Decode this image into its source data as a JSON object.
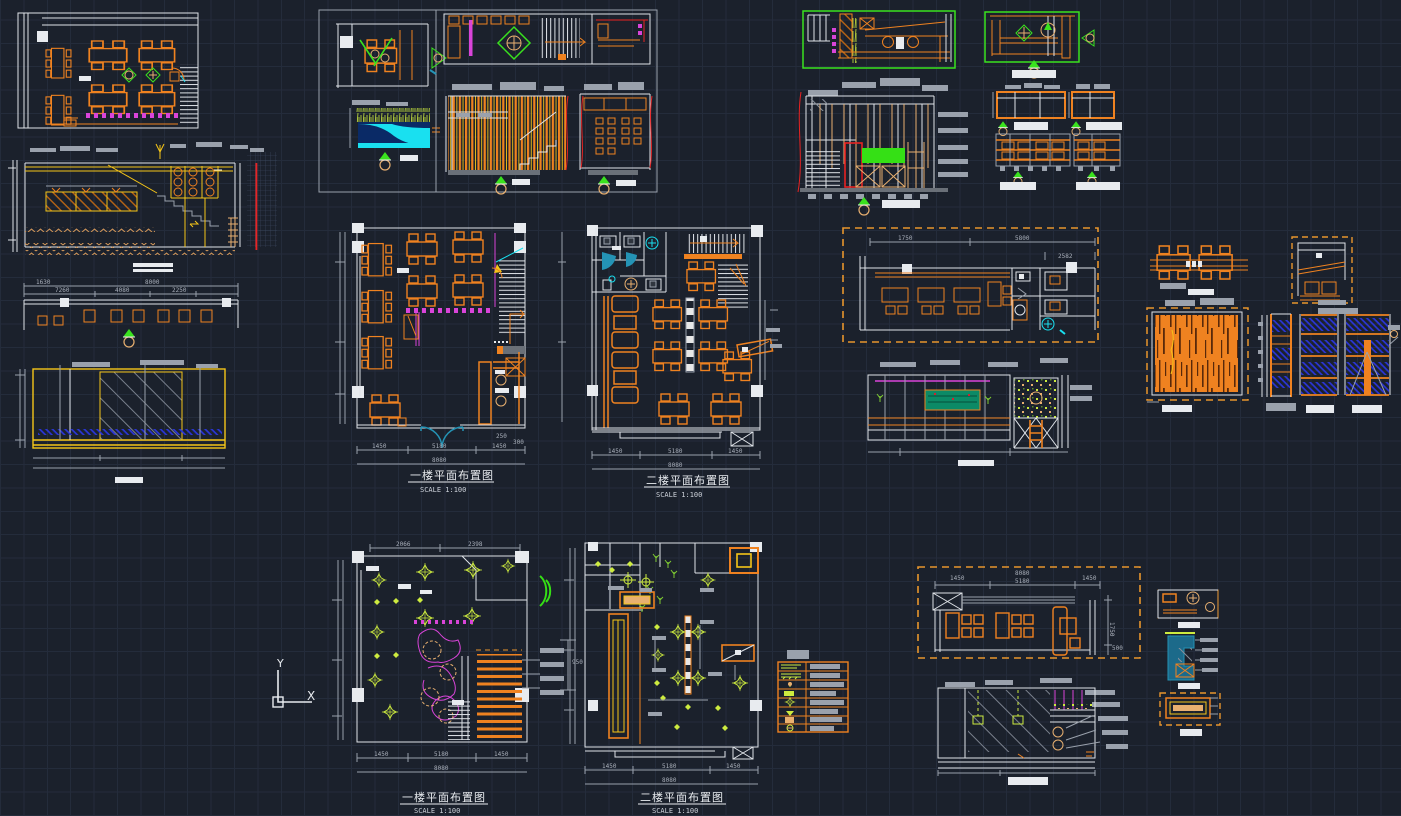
{
  "canvas": {
    "background": "#1b212c",
    "grid_color": "#242c3b",
    "grid_size_px": 23
  },
  "palette": {
    "orange": "#ef8220",
    "yellow": "#f5c518",
    "bright_green": "#3ae21e",
    "lime": "#cdeb3f",
    "magenta": "#d944d9",
    "cyan_door": "#2493b5",
    "aqua": "#19e0f0",
    "red": "#e82222",
    "blue_hatch": "#2a35d8",
    "white": "#e8ebef",
    "gray": "#9aa1ac",
    "teal_board": "#0c8a66",
    "water": "#0a2a66",
    "steel_section": "#1c6a8a",
    "tan": "#e8b070"
  },
  "drawings": {
    "floor_plan_1": {
      "title": "一楼平面布置图",
      "scale": "SCALE 1:100"
    },
    "floor_plan_2": {
      "title": "二楼平面布置图",
      "scale": "SCALE 1:100"
    },
    "ceiling_plan_1": {
      "title": "一楼平面布置图",
      "scale": "SCALE 1:100"
    },
    "ceiling_plan_2": {
      "title": "二楼平面布置图",
      "scale": "SCALE 1:100"
    }
  },
  "dims": {
    "d1450": "1450",
    "d5180": "5180",
    "d8080": "8080",
    "d250": "250",
    "d300": "300",
    "d1750": "1750",
    "d5800": "5800",
    "d2582": "2582",
    "d1630": "1630",
    "d7260": "7260",
    "d4080": "4080",
    "d2250": "2250",
    "d8000": "8000",
    "d2066": "2066",
    "d2398": "2398",
    "d500": "500",
    "d950": "950"
  },
  "ucs": {
    "x": "X",
    "y": "Y"
  }
}
